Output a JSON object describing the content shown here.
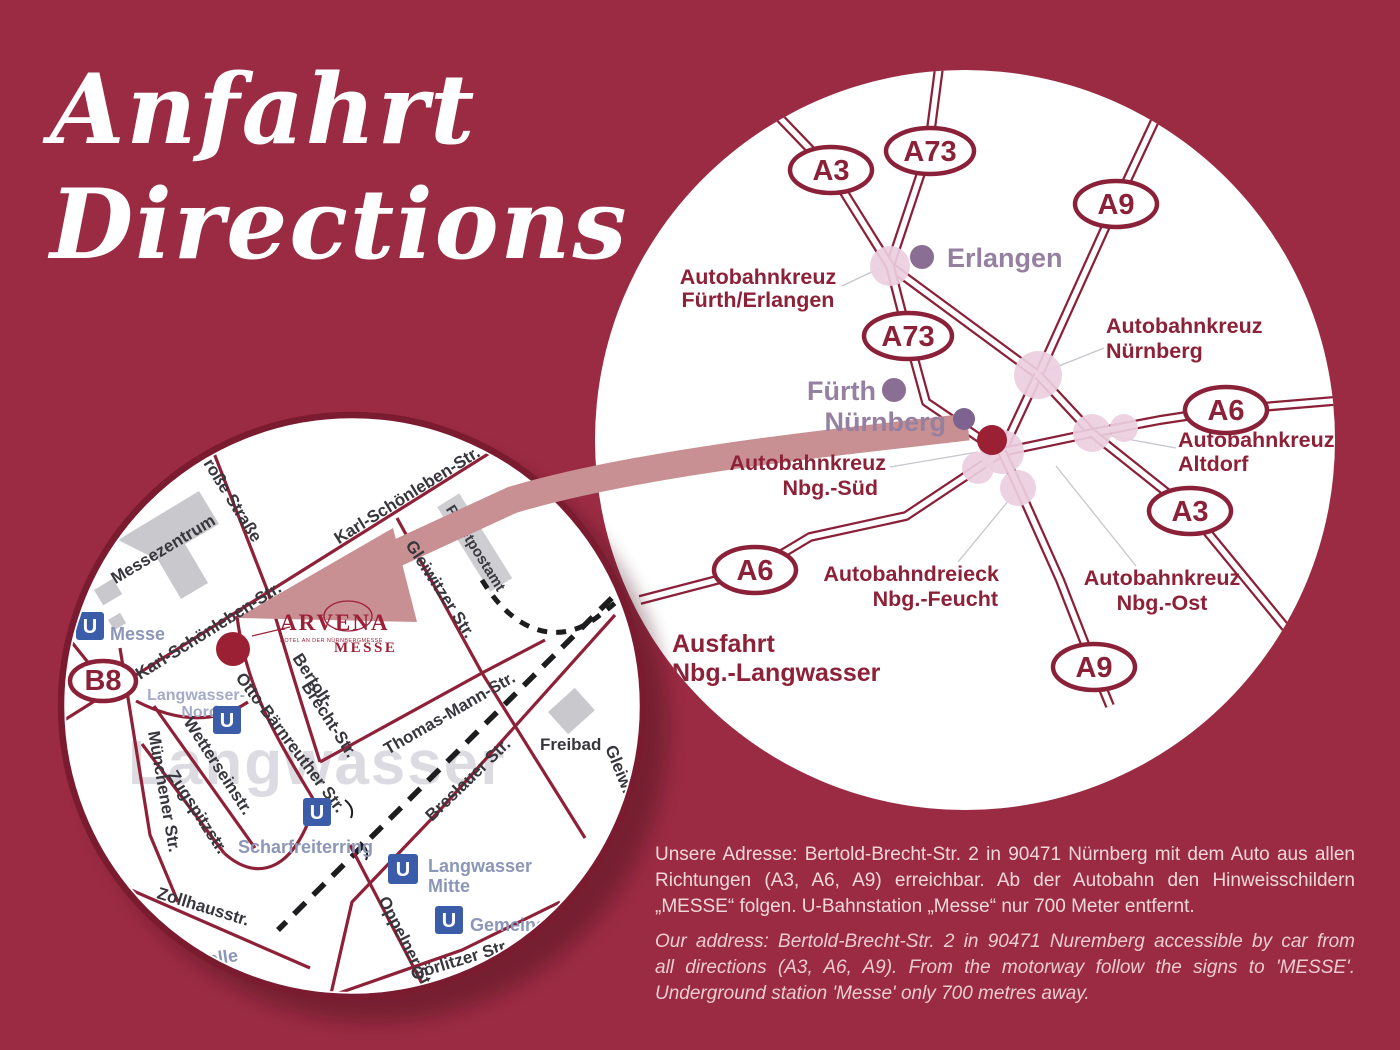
{
  "title": {
    "line1": "Anfahrt",
    "line2": "Directions"
  },
  "overview_map": {
    "badges": [
      {
        "label": "A3"
      },
      {
        "label": "A73"
      },
      {
        "label": "A9"
      },
      {
        "label": "A73"
      },
      {
        "label": "A6"
      },
      {
        "label": "A3"
      },
      {
        "label": "A6"
      },
      {
        "label": "A9"
      }
    ],
    "cities": [
      {
        "name": "Erlangen"
      },
      {
        "name": "Fürth"
      },
      {
        "name": "Nürnberg"
      }
    ],
    "junctions": [
      {
        "line1": "Autobahnkreuz",
        "line2": "Fürth/Erlangen"
      },
      {
        "line1": "Autobahnkreuz",
        "line2": "Nürnberg"
      },
      {
        "line1": "Autobahnkreuz",
        "line2": "Altdorf"
      },
      {
        "line1": "Autobahnkreuz",
        "line2": "Nbg.-Süd"
      },
      {
        "line1": "Autobahndreieck",
        "line2": "Nbg.-Feucht"
      },
      {
        "line1": "Autobahnkreuz",
        "line2": "Nbg.-Ost"
      }
    ],
    "exit": {
      "line1": "Ausfahrt",
      "line2": "Nbg.-Langwasser"
    }
  },
  "detail_map": {
    "route_badge": "B8",
    "u_symbol": "U",
    "district_watermark": "Langwasser",
    "streets": [
      {
        "name": "Große Straße"
      },
      {
        "name": "Karl-Schönleben-Str."
      },
      {
        "name": "Karl-Schönleben-Str."
      },
      {
        "name": "Münchener Str."
      },
      {
        "name": "Zollhausstr."
      },
      {
        "name": "Wetterseinstr."
      },
      {
        "name": "Zugspitzstr."
      },
      {
        "name": "Otto-Bärnreuther Str."
      },
      {
        "name": "Bertolt-"
      },
      {
        "name": "Brecht-Str."
      },
      {
        "name": "Thomas-Mann-Str."
      },
      {
        "name": "Gleiwitzer Str."
      },
      {
        "name": "Breslauer Str."
      },
      {
        "name": "Oppelner Str."
      },
      {
        "name": "Görlitzer Str."
      },
      {
        "name": "Gleiwi"
      }
    ],
    "places": [
      {
        "name": "Messezentrum"
      },
      {
        "name": "Paketpostamt"
      },
      {
        "name": "Freibad"
      }
    ],
    "stations": [
      {
        "name": "Messe"
      },
      {
        "name": "Langwasser-"
      },
      {
        "name": "Nord"
      },
      {
        "name": "Scharfreiterring"
      },
      {
        "name": "Langwasser"
      },
      {
        "name": "Mitte"
      },
      {
        "name": "Gemeinsch"
      },
      {
        "name": "telle"
      }
    ],
    "logo": {
      "name": "ARVENA",
      "division": "MESSE",
      "tagline": "Hotel an der NürnbergMesse"
    }
  },
  "footer": {
    "de_lines": [
      "Unsere Adresse: Bertold-Brecht-Str. 2 in 90471 Nürnberg mit dem Auto aus allen",
      "Richtungen (A3, A6, A9) erreichbar. Ab der Autobahn den Hinweisschildern",
      "„MESSE“ folgen. U-Bahnstation „Messe“ nur 700 Meter entfernt."
    ],
    "en_lines": [
      "Our address: Bertold-Brecht-Str. 2 in 90471 Nuremberg accessible by car from",
      "all directions (A3, A6, A9). From the motorway follow the signs to 'MESSE'.",
      "Underground station 'Messe' only 700 metres away."
    ]
  },
  "colors": {
    "background": "#9a2b43",
    "road": "#8b2138",
    "route_arrow": "#c99093",
    "interchange_halo": "#eccfe0",
    "city_dot": "#8b6e94",
    "hotel_marker": "#9b2033",
    "ubahn_blue": "#3b5ca8",
    "station_label": "#8b96b8",
    "street_label": "#37363c",
    "building_gray": "#c9c8cd",
    "watermark_gray": "#dcdbe1",
    "footer_text": "#f0d8da"
  }
}
